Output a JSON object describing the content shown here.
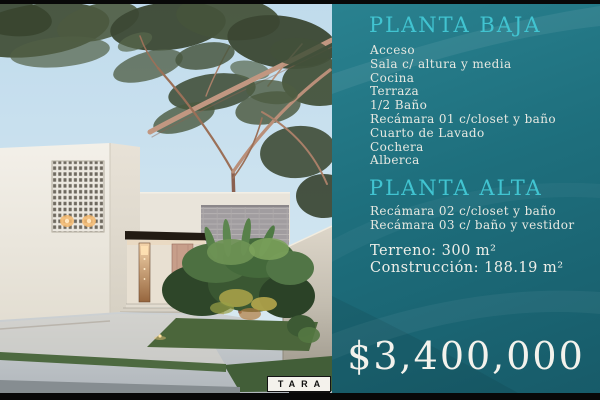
{
  "panel": {
    "planta_baja": {
      "title": "PLANTA BAJA",
      "items": [
        "Acceso",
        "Sala c/ altura y media",
        "Cocina",
        "Terraza",
        "1/2 Baño",
        "Recámara 01 c/closet y baño",
        "Cuarto de Lavado",
        "Cochera",
        "Alberca"
      ]
    },
    "planta_alta": {
      "title": "PLANTA ALTA",
      "items": [
        "Recámara 02 c/closet y baño",
        "Recámara 03 c/ baño y vestidor"
      ]
    },
    "specs": {
      "terreno": "Terreno: 300 m²",
      "construccion": "Construcción: 188.19 m²"
    },
    "price": "$3,400,000",
    "colors": {
      "background": "#1e6f7d",
      "heading": "#41c4d1",
      "body_text": "#e6e8e1",
      "price_text": "#f3f2ec"
    }
  },
  "photo": {
    "logo_text": "TARA"
  }
}
